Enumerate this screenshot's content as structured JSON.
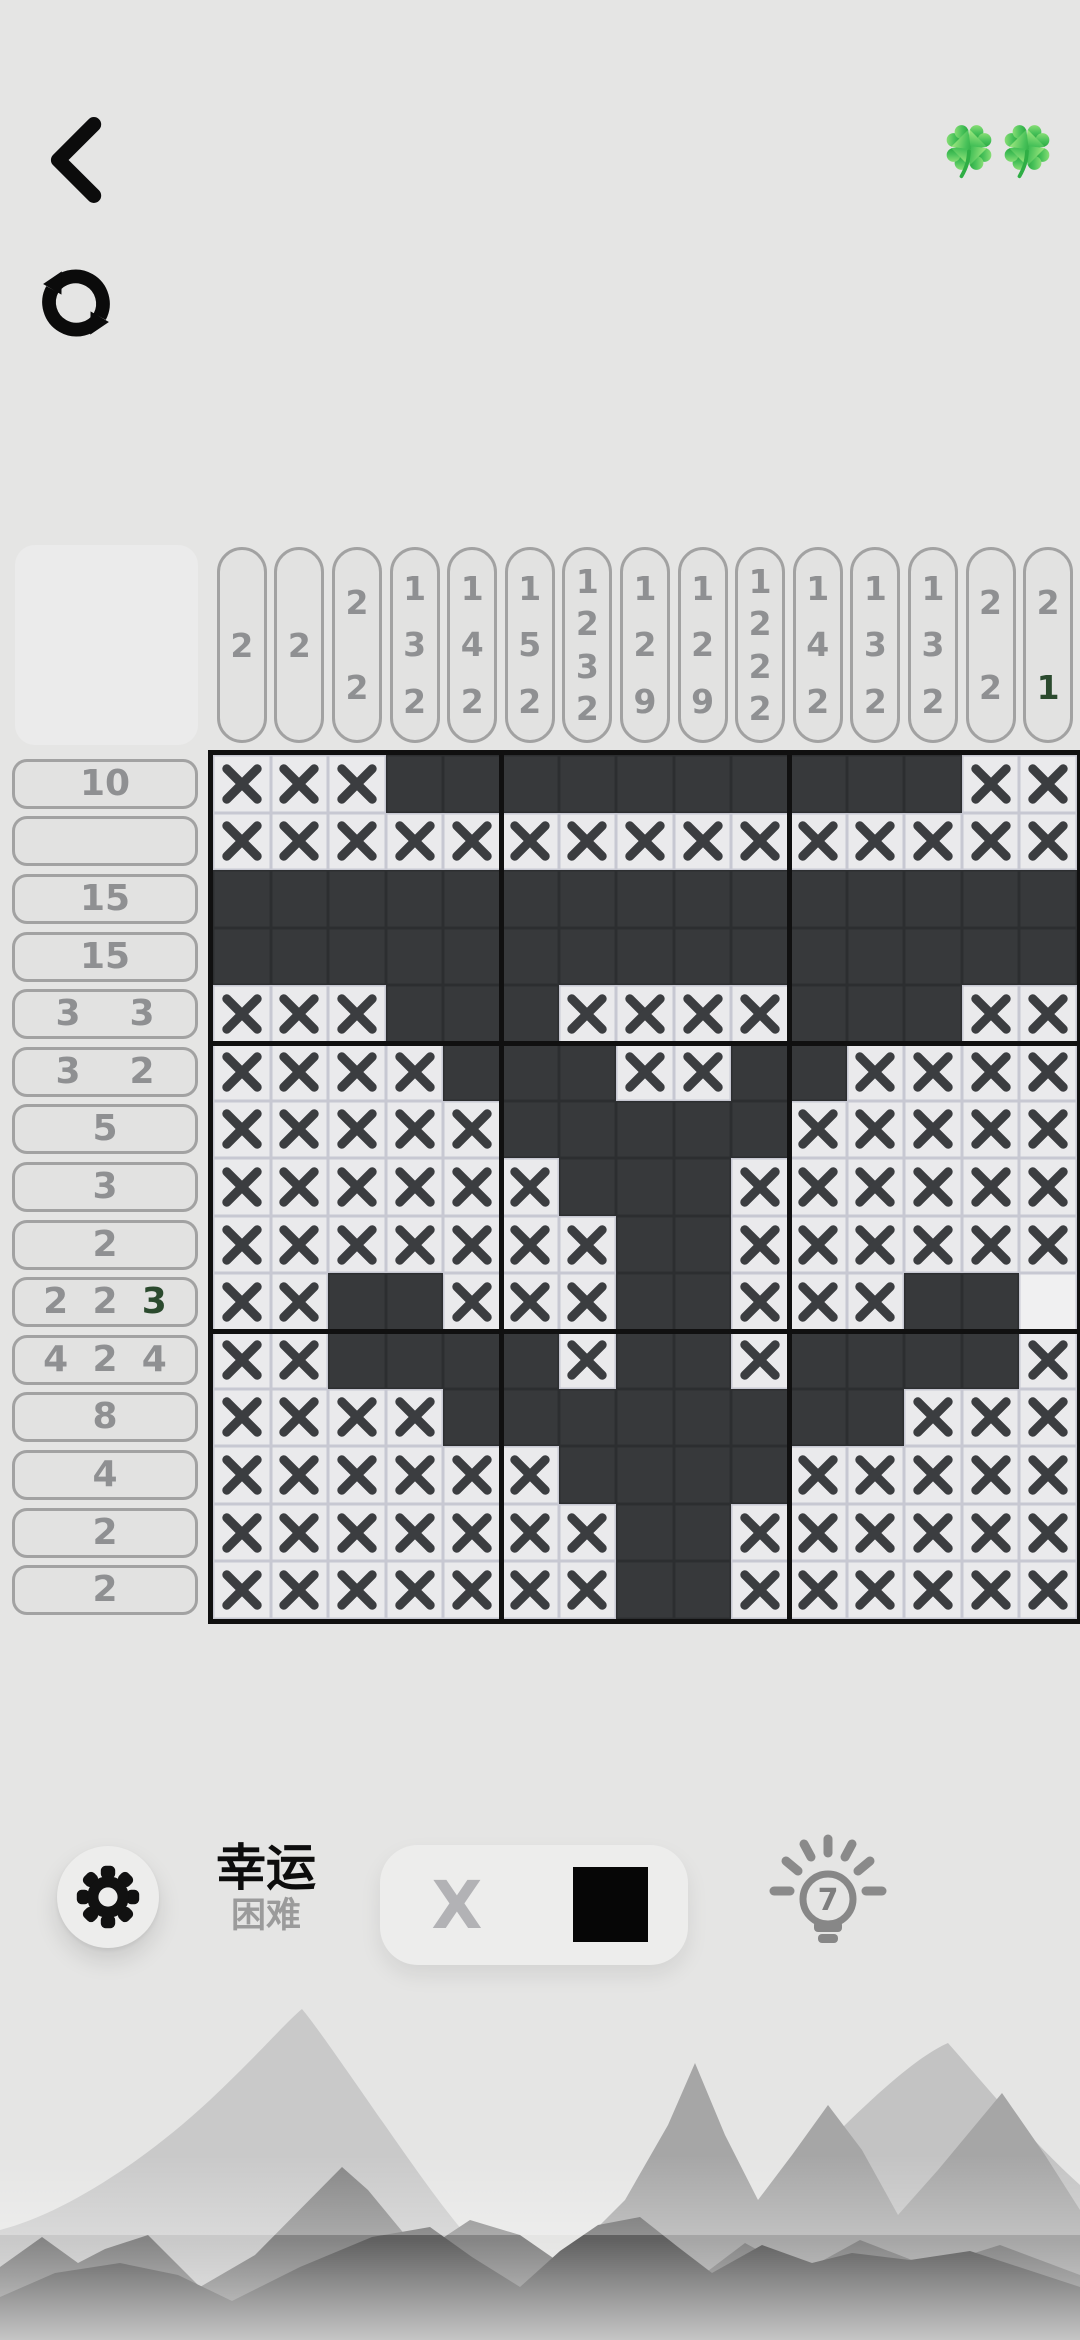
{
  "header": {
    "clover_count": 2
  },
  "puzzle": {
    "size": 15,
    "col_clues": [
      [
        "2"
      ],
      [
        "2"
      ],
      [
        "2",
        "2"
      ],
      [
        "1",
        "3",
        "2"
      ],
      [
        "1",
        "4",
        "2"
      ],
      [
        "1",
        "5",
        "2"
      ],
      [
        "1",
        "2",
        "3",
        "2"
      ],
      [
        "1",
        "2",
        "9"
      ],
      [
        "1",
        "2",
        "9"
      ],
      [
        "1",
        "2",
        "2",
        "2"
      ],
      [
        "1",
        "4",
        "2"
      ],
      [
        "1",
        "3",
        "2"
      ],
      [
        "1",
        "3",
        "2"
      ],
      [
        "2",
        "2"
      ],
      [
        "2",
        "1"
      ]
    ],
    "row_clues": [
      [
        "10"
      ],
      [],
      [
        "15"
      ],
      [
        "15"
      ],
      [
        "3",
        "3"
      ],
      [
        "3",
        "2"
      ],
      [
        "5"
      ],
      [
        "3"
      ],
      [
        "2"
      ],
      [
        "2",
        "2",
        "3"
      ],
      [
        "4",
        "2",
        "4"
      ],
      [
        "8"
      ],
      [
        "4"
      ],
      [
        "2"
      ],
      [
        "2"
      ]
    ],
    "pending_clues": {
      "rows": [
        [
          9,
          2
        ]
      ],
      "cols": [
        [
          14,
          1
        ]
      ]
    },
    "grid_rows": [
      "XXXFFFFFFFFFFXX",
      "XXXXXXXXXXXXXXX",
      "FFFFFFFFFFFFFFF",
      "FFFFFFFFFFFFFFF",
      "XXXFFFXXXXFFFXX",
      "XXXXFFFXXFFXXXX",
      "XXXXXFFFFFXXXXX",
      "XXXXXXFFFXXXXXX",
      "XXXXXXXFFXXXXXX",
      "XXFFXXXFFXXXFFE",
      "XXFFFFXFFXFFFFX",
      "XXXXFFFFFFFFXXX",
      "XXXXXXFFFFXXXXX",
      "XXXXXXXFFXXXXXX",
      "XXXXXXXFFXXXXXX"
    ]
  },
  "footer": {
    "level_name": "幸运",
    "difficulty": "困难",
    "mode_x_label": "X",
    "hint_count": "7"
  },
  "colors": {
    "page_bg": "#e5e5e4",
    "cell_filled": "#37393b",
    "cell_light": "#eaeaec",
    "cell_hint_empty": "#f0f0f1",
    "x_mark": "#3b3d40",
    "grid_line_light": "#c7c8d2",
    "grid_line_dark": "#2c2e30",
    "block_line": "#101010",
    "clue_text": "#8f9092",
    "clue_pending": "#2b4a2e",
    "clover_green": "#2fae45",
    "icon_black": "#0c0c0c",
    "hint_gray": "#8a8a8a"
  }
}
